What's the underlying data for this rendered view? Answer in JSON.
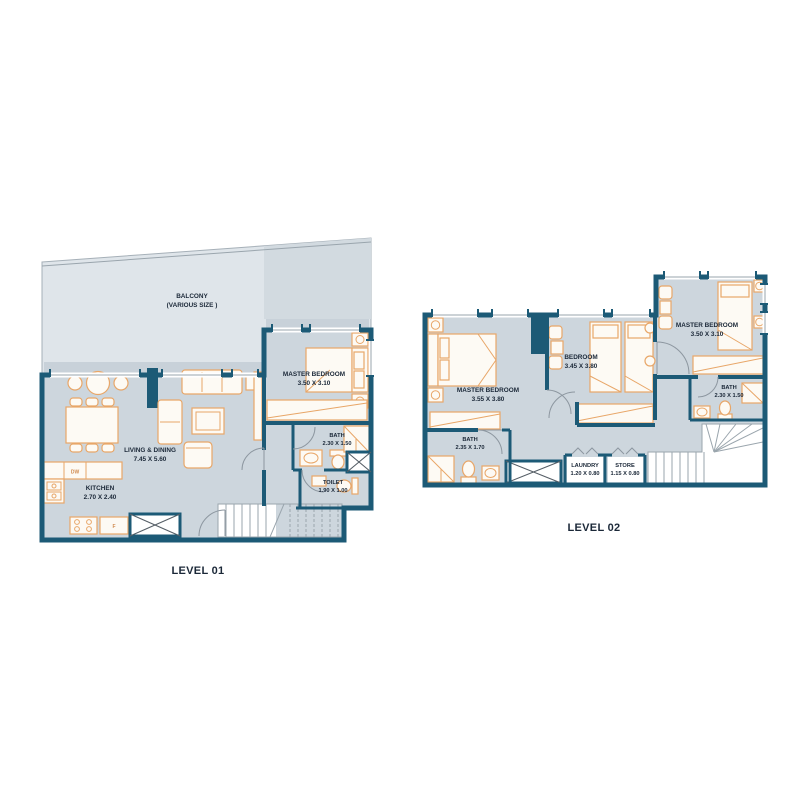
{
  "plan": {
    "colors": {
      "wall": "#1c5a76",
      "floor": "#cdd6dd",
      "balcony_floor": "#dfe5ea",
      "furniture_outline": "#e8a668",
      "label_text": "#1b2838"
    },
    "levels": [
      {
        "title": "LEVEL 01",
        "rooms": {
          "balcony": {
            "name": "BALCONY",
            "dims": "(VARIOUS SIZE )"
          },
          "living_dining": {
            "name": "LIVING & DINING",
            "dims": "7.45 X 5.60"
          },
          "kitchen": {
            "name": "KITCHEN",
            "dims": "2.70 X 2.40"
          },
          "master_bedroom": {
            "name": "MASTER BEDROOM",
            "dims": "3.50 X 3.10"
          },
          "bath": {
            "name": "BATH",
            "dims": "2.30 X 1.50"
          },
          "toilet": {
            "name": "TOILET",
            "dims": "1.90 X 1.00"
          }
        },
        "appliances": {
          "dishwasher": "DW",
          "fridge": "F"
        }
      },
      {
        "title": "LEVEL 02",
        "rooms": {
          "master_bedroom_left": {
            "name": "MASTER BEDROOM",
            "dims": "3.55 X 3.80"
          },
          "bedroom": {
            "name": "BEDROOM",
            "dims": "3.45 X 3.80"
          },
          "master_bedroom_right": {
            "name": "MASTER BEDROOM",
            "dims": "3.50 X 3.10"
          },
          "bath_left": {
            "name": "BATH",
            "dims": "2.35 X 1.70"
          },
          "bath_right": {
            "name": "BATH",
            "dims": "2.30 X 1.50"
          },
          "laundry": {
            "name": "LAUNDRY",
            "dims": "1.20 X 0.80"
          },
          "store": {
            "name": "STORE",
            "dims": "1.15 X 0.80"
          }
        }
      }
    ]
  }
}
